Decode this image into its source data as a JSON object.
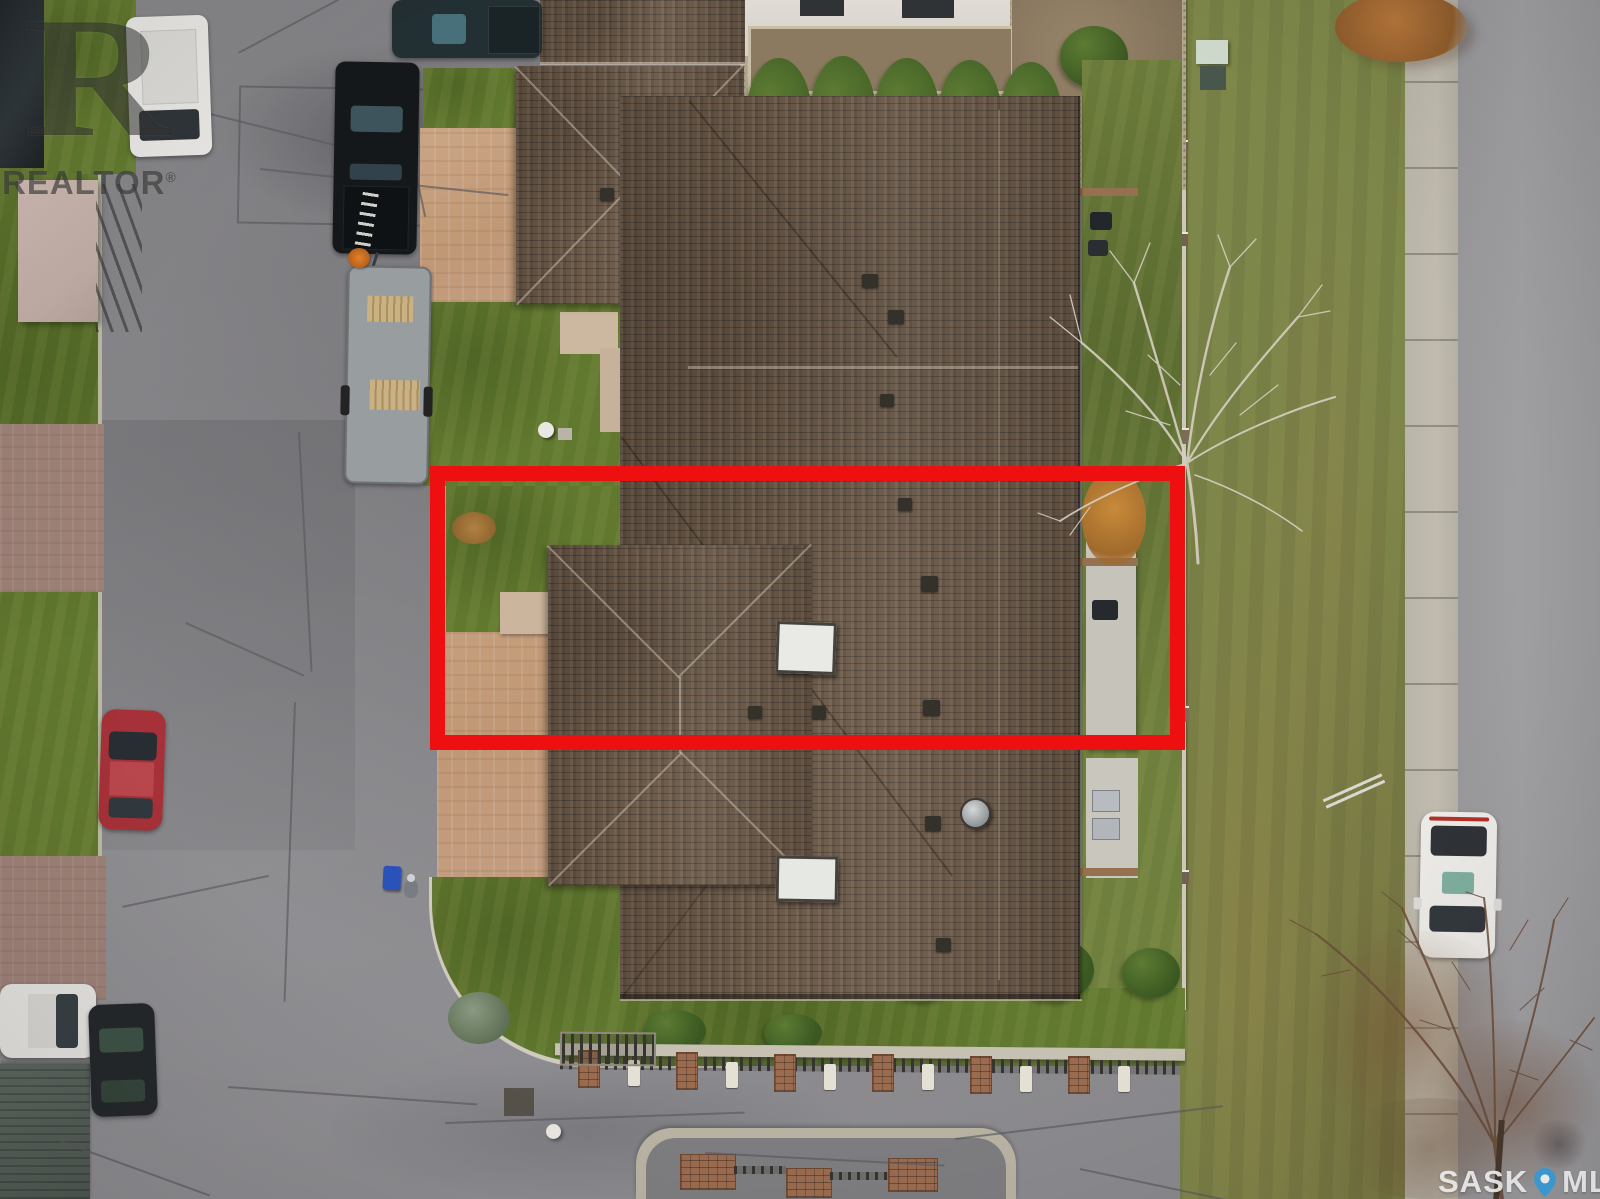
{
  "watermarks": {
    "realtor": {
      "monogram": "R",
      "label": "REALTOR",
      "registered": "®"
    },
    "sask_mls": {
      "brand_left": "SASK",
      "brand_right": "MLS",
      "registered": "®"
    }
  },
  "annotation": {
    "style": "rectangle-outline",
    "highlight_color": "#ee1010"
  },
  "palette": {
    "highlight": "#ee1010",
    "pin": "#41a5e1",
    "asphalt": "#8a898c",
    "street": "#9b9a9d",
    "sidewalk": "#b9b4a8",
    "blvdgrass": "#7d8749",
    "grass": "#61782f",
    "roof": "#6b5948",
    "driveway": "#c49e80",
    "mauve": "#9d8177",
    "gravel": "#b2a68e",
    "curb": "#d0cbbe"
  }
}
